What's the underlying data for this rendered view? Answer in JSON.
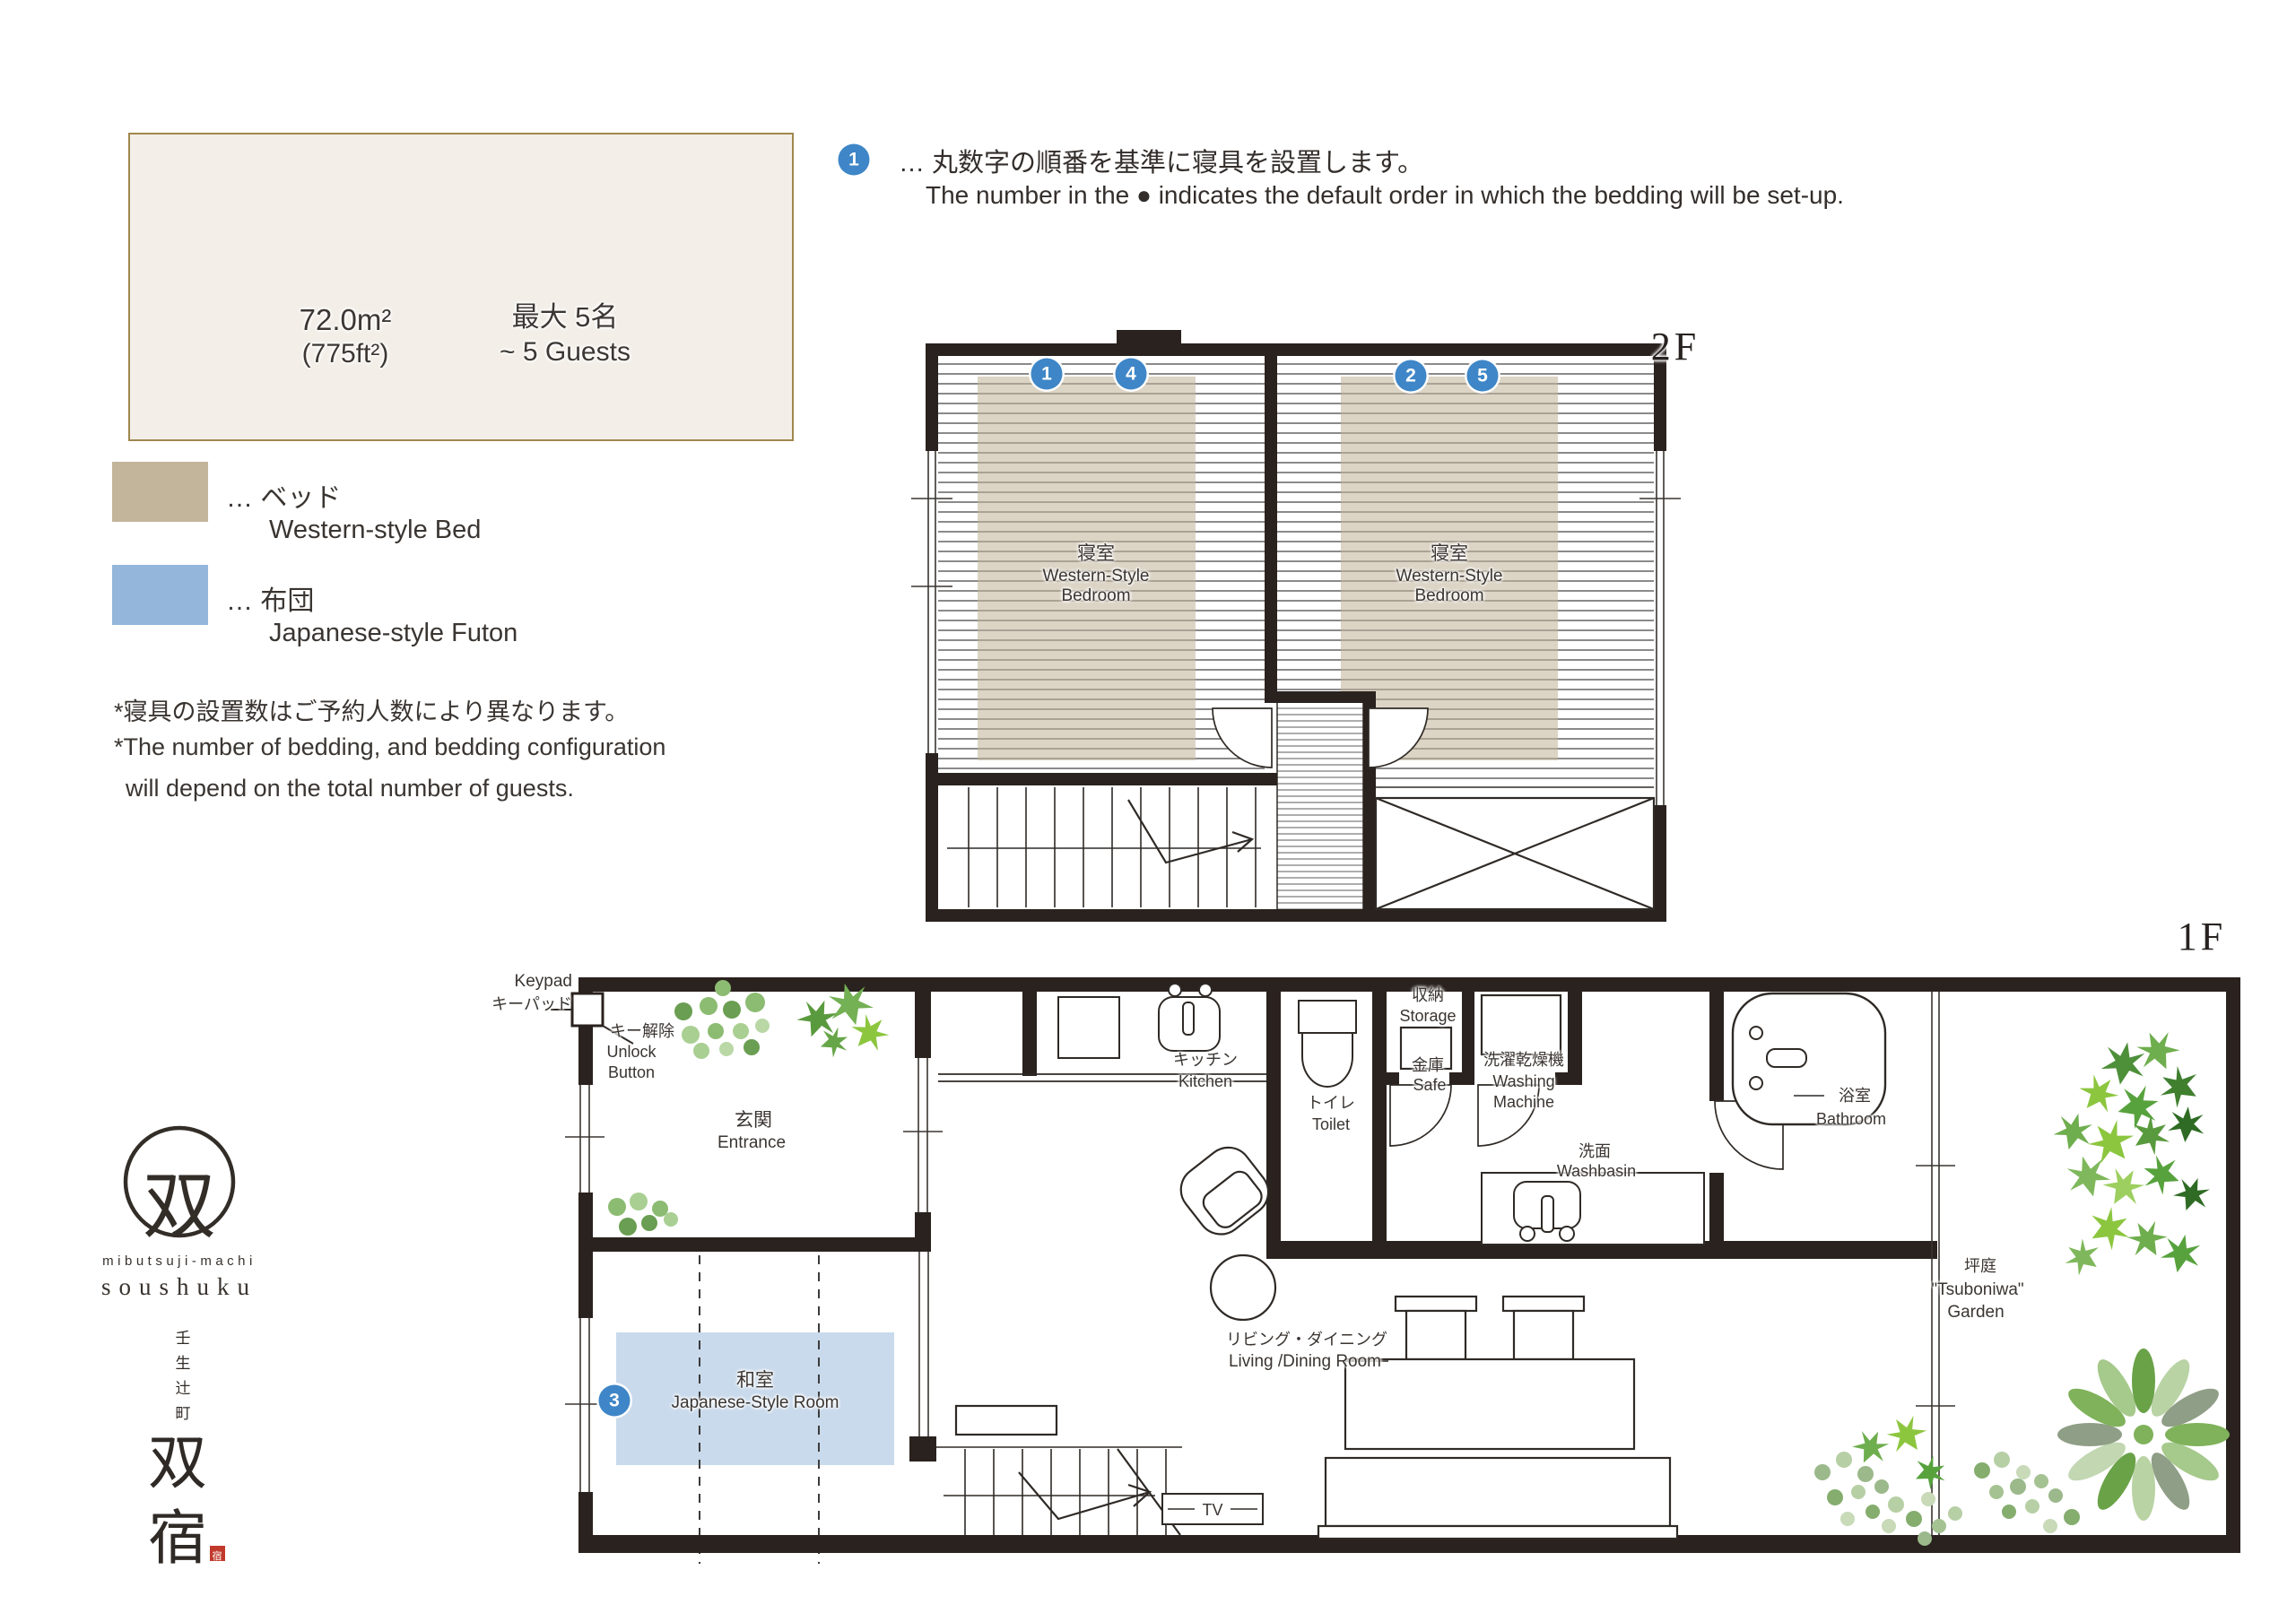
{
  "info": {
    "area": "72.0m²",
    "area_ft": "(775ft²)",
    "capacity_jp": "最大 5名",
    "capacity_en": "~ 5 Guests"
  },
  "legend": {
    "bed_jp": "… ベッド",
    "bed_en": "Western-style Bed",
    "futon_jp": "… 布団",
    "futon_en": "Japanese-style Futon"
  },
  "notes": {
    "l1": "*寝具の設置数はご予約人数により異なります。",
    "l2": "*The number of bedding, and bedding configuration",
    "l3": "will depend on the total number of guests."
  },
  "note_top": {
    "num": "1",
    "jp": "… 丸数字の順番を基準に寝具を設置します。",
    "en": "The number in the ● indicates the default order in which the bedding will be set-up."
  },
  "floor2": {
    "tag": "2F",
    "bedroom_jp": "寝室",
    "bedroom_en1": "Western-Style",
    "bedroom_en2": "Bedroom",
    "bed_numbers": [
      "1",
      "4",
      "2",
      "5"
    ]
  },
  "floor1": {
    "tag": "1F",
    "keypad_en": "Keypad",
    "keypad_jp": "キーパッド",
    "unlock_jp": "キー解除",
    "unlock_en1": "Unlock",
    "unlock_en2": "Button",
    "entrance_jp": "玄関",
    "entrance_en": "Entrance",
    "kitchen_jp": "キッチン",
    "kitchen_en": "Kitchen",
    "toilet_jp": "トイレ",
    "toilet_en": "Toilet",
    "storage_jp": "収納",
    "storage_en": "Storage",
    "safe_jp": "金庫",
    "safe_en": "Safe",
    "washer_jp": "洗濯乾燥機",
    "washer_en1": "Washing",
    "washer_en2": "Machine",
    "washbasin_jp": "洗面",
    "washbasin_en": "Washbasin",
    "bath_jp": "浴室",
    "bath_en": "Bathroom",
    "living_jp": "リビング・ダイニング",
    "living_en": "Living /Dining Room",
    "tatami_jp": "和室",
    "tatami_en": "Japanese-Style Room",
    "tatami_num": "3",
    "garden_jp": "坪庭",
    "garden_en1": "\"Tsuboniwa\"",
    "garden_en2": "Garden",
    "tv": "TV"
  },
  "logo": {
    "mark": "双",
    "sub": "mibutsuji-machi",
    "name": "soushuku",
    "address": [
      "壬",
      "生",
      "辻",
      "町"
    ],
    "brand": [
      "双",
      "宿"
    ],
    "seal": "宿"
  },
  "colors": {
    "bed": "#c3b59b",
    "futon": "#93b6da",
    "bubble": "#3e86c7",
    "wall": "#2a221e",
    "gold_border": "#a1874e"
  }
}
